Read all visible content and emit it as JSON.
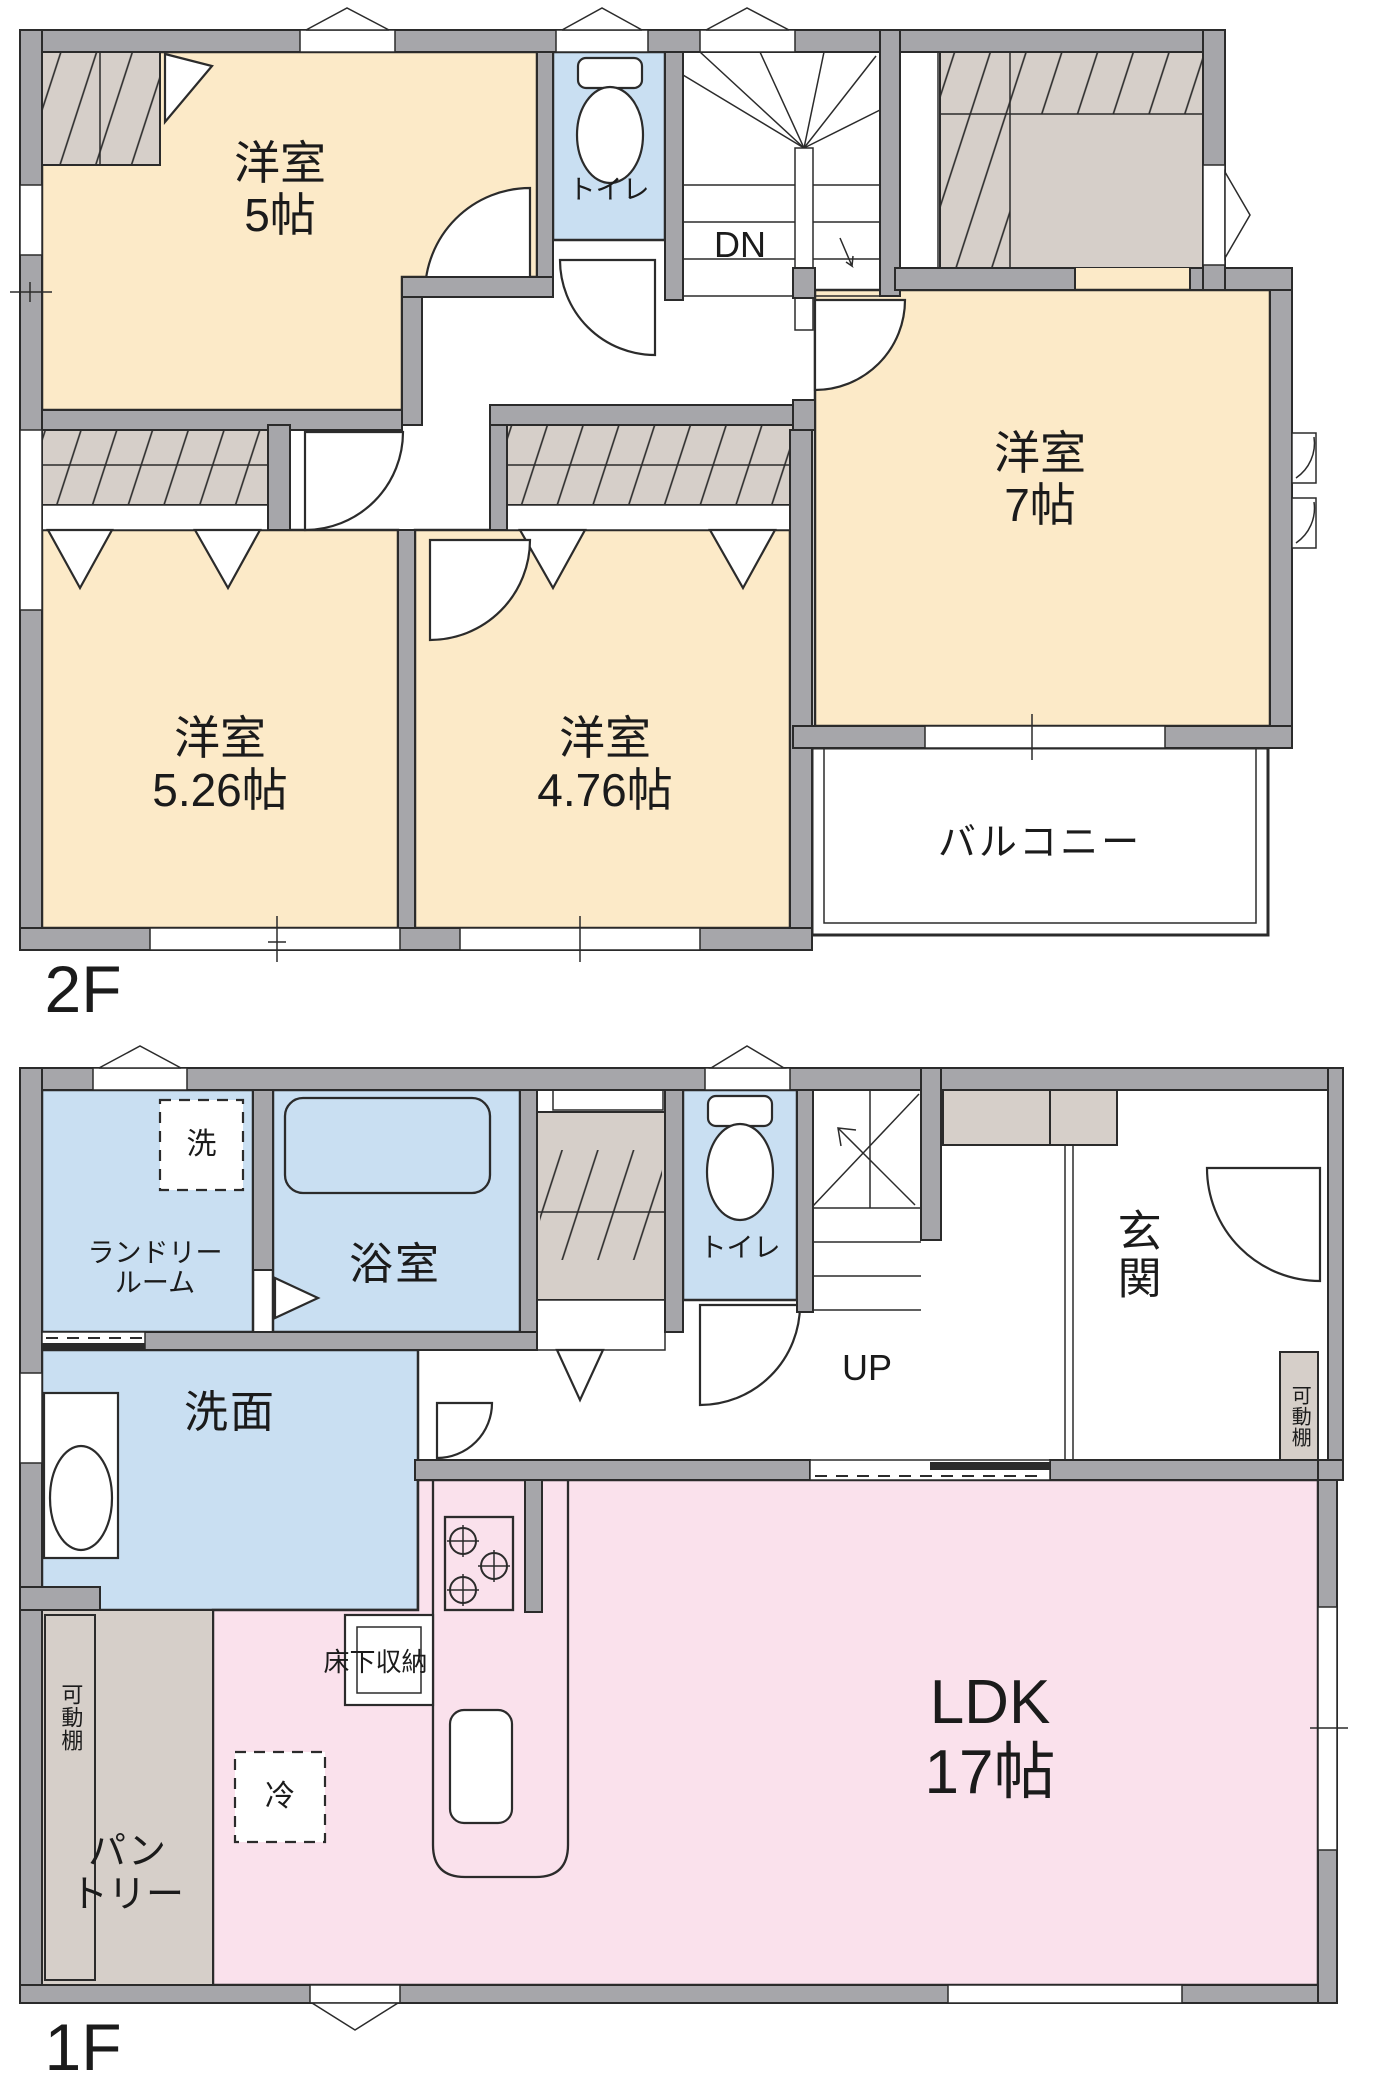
{
  "colors": {
    "wall": "#A6A6AA",
    "line": "#2B2B2B",
    "room_cream": "#FCEAC8",
    "room_blue": "#C9DFF2",
    "room_pink": "#FAE1EC",
    "closet_beige": "#D6CFC9",
    "text": "#1B1B1B",
    "bg": "#FFFFFF"
  },
  "floor_2f": {
    "label": "2F",
    "rooms": {
      "bedroom5": {
        "name": "洋室",
        "size": "5帖"
      },
      "toilet": {
        "name": "トイレ"
      },
      "stairs": {
        "direction": "DN"
      },
      "bedroom7": {
        "name": "洋室",
        "size": "7帖"
      },
      "bedroom526": {
        "name": "洋室",
        "size": "5.26帖"
      },
      "bedroom476": {
        "name": "洋室",
        "size": "4.76帖"
      },
      "balcony": {
        "name": "バルコニー"
      }
    }
  },
  "floor_1f": {
    "label": "1F",
    "rooms": {
      "washer": {
        "name": "洗"
      },
      "laundry": {
        "line1": "ランドリー",
        "line2": "ルーム"
      },
      "bathroom": {
        "name": "浴室"
      },
      "toilet": {
        "name": "トイレ"
      },
      "stairs": {
        "direction": "UP"
      },
      "entrance": {
        "name": "玄関"
      },
      "shelf_right": {
        "name": "可動棚"
      },
      "washroom": {
        "name": "洗面"
      },
      "ldk": {
        "name": "LDK",
        "size": "17帖"
      },
      "floor_storage": {
        "name": "床下収納"
      },
      "fridge": {
        "name": "冷"
      },
      "pantry": {
        "line1": "パン",
        "line2": "トリー"
      },
      "shelf_left": {
        "name": "可動棚"
      }
    }
  }
}
